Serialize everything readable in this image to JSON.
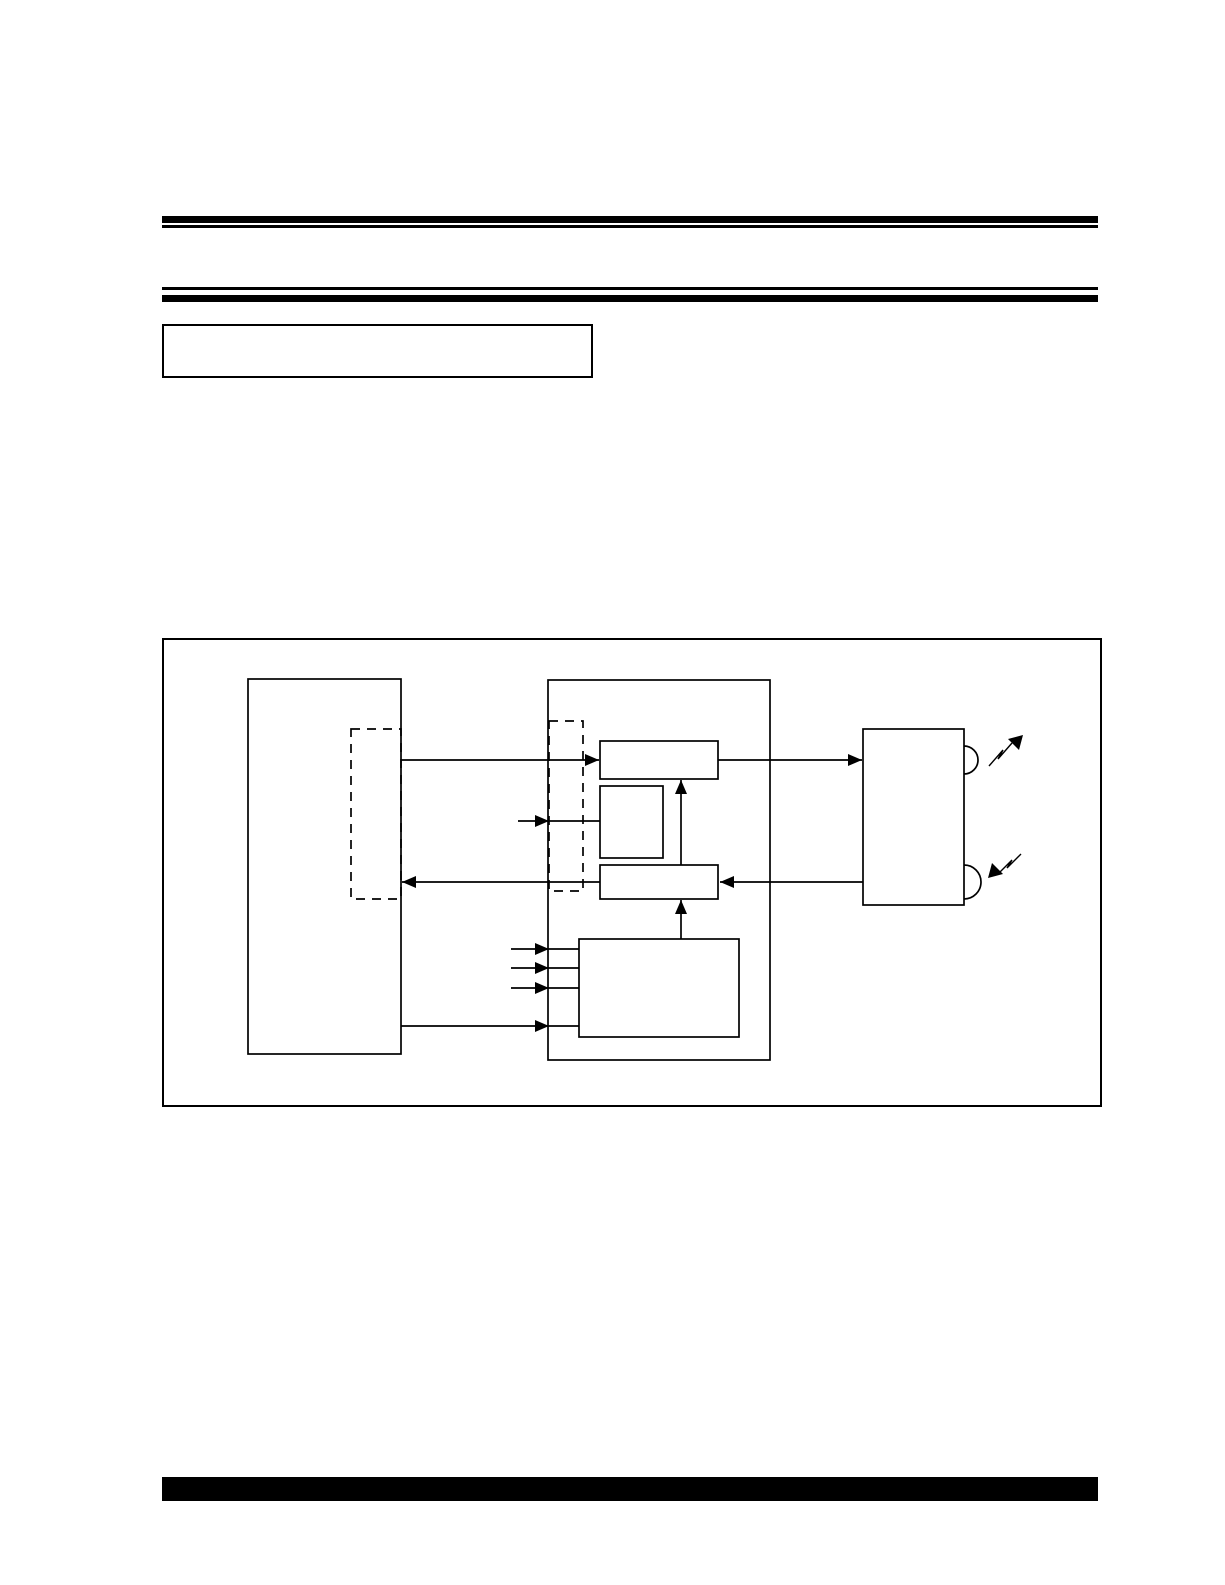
{
  "page": {
    "background_color": "#ffffff",
    "ink_color": "#000000",
    "title_box_text": "",
    "figure_caption_text": ""
  },
  "header": {
    "double_rules": 2,
    "rule_color": "#000000"
  },
  "footer": {
    "bar_color": "#000000"
  },
  "figure": {
    "diagram": {
      "type": "block-diagram",
      "blocks": [
        {
          "id": "left-block",
          "style": "solid",
          "label": ""
        },
        {
          "id": "left-inner-region",
          "style": "dashed",
          "label": ""
        },
        {
          "id": "center-block",
          "style": "solid",
          "label": ""
        },
        {
          "id": "center-inner-region",
          "style": "dashed",
          "label": ""
        },
        {
          "id": "sub-block-top",
          "style": "solid",
          "label": ""
        },
        {
          "id": "sub-block-square",
          "style": "solid",
          "label": ""
        },
        {
          "id": "sub-block-lower",
          "style": "solid",
          "label": ""
        },
        {
          "id": "sub-block-bottom",
          "style": "solid",
          "label": ""
        },
        {
          "id": "right-block",
          "style": "solid",
          "label": "",
          "ports": 2
        }
      ],
      "connections": [
        {
          "from": "left-block",
          "to": "sub-block-top",
          "arrow": "right"
        },
        {
          "from": "sub-block-top",
          "to": "right-block",
          "arrow": "right"
        },
        {
          "from": "external-input",
          "to": "sub-block-square",
          "arrow": "right"
        },
        {
          "from": "right-block",
          "to": "sub-block-lower",
          "arrow": "left"
        },
        {
          "from": "sub-block-lower",
          "to": "left-block",
          "arrow": "left"
        },
        {
          "from": "sub-block-lower",
          "to": "sub-block-top",
          "arrow": "up"
        },
        {
          "from": "sub-block-bottom",
          "to": "sub-block-lower",
          "arrow": "up"
        },
        {
          "from": "external-input",
          "to": "sub-block-bottom",
          "arrow": "right",
          "count": 3
        },
        {
          "from": "left-block",
          "to": "sub-block-bottom",
          "arrow": "right"
        },
        {
          "from": "right-block",
          "to": "air",
          "type": "rf-wave-out"
        },
        {
          "from": "air",
          "to": "right-block",
          "type": "rf-wave-in"
        }
      ]
    }
  }
}
